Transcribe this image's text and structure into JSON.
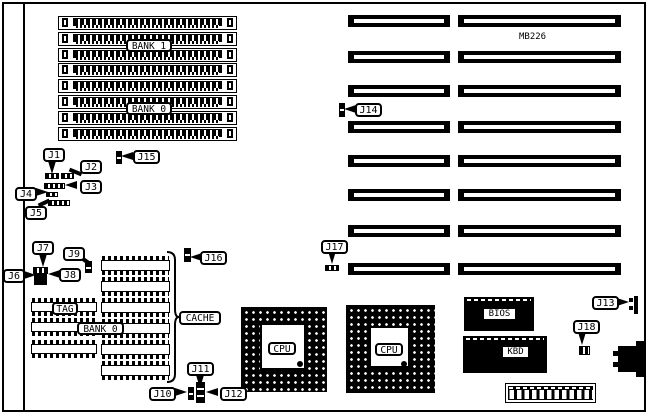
{
  "model_label": "MB226",
  "memory": {
    "bank1_label": "BANK 1",
    "bank0_label": "BANK 0",
    "simm_socket_count": 8
  },
  "expansion": {
    "slot_row_count": 8
  },
  "cache_area": {
    "tag_label": "TAG",
    "bank0_label": "BANK 0",
    "cache_label": "CACHE",
    "left_chip_count": 3,
    "right_chip_count": 6
  },
  "cpu_sockets": {
    "cpu1_label": "CPU",
    "cpu2_label": "CPU"
  },
  "chips": {
    "bios_label": "BIOS",
    "kbd_label": "KBD"
  },
  "callouts": {
    "j1": "J1",
    "j2": "J2",
    "j3": "J3",
    "j4": "J4",
    "j5": "J5",
    "j6": "J6",
    "j7": "J7",
    "j8": "J8",
    "j9": "J9",
    "j10": "J10",
    "j11": "J11",
    "j12": "J12",
    "j13": "J13",
    "j14": "J14",
    "j15": "J15",
    "j16": "J16",
    "j17": "J17",
    "j18": "J18"
  },
  "colors": {
    "ink": "#000000",
    "paper": "#ffffff"
  }
}
